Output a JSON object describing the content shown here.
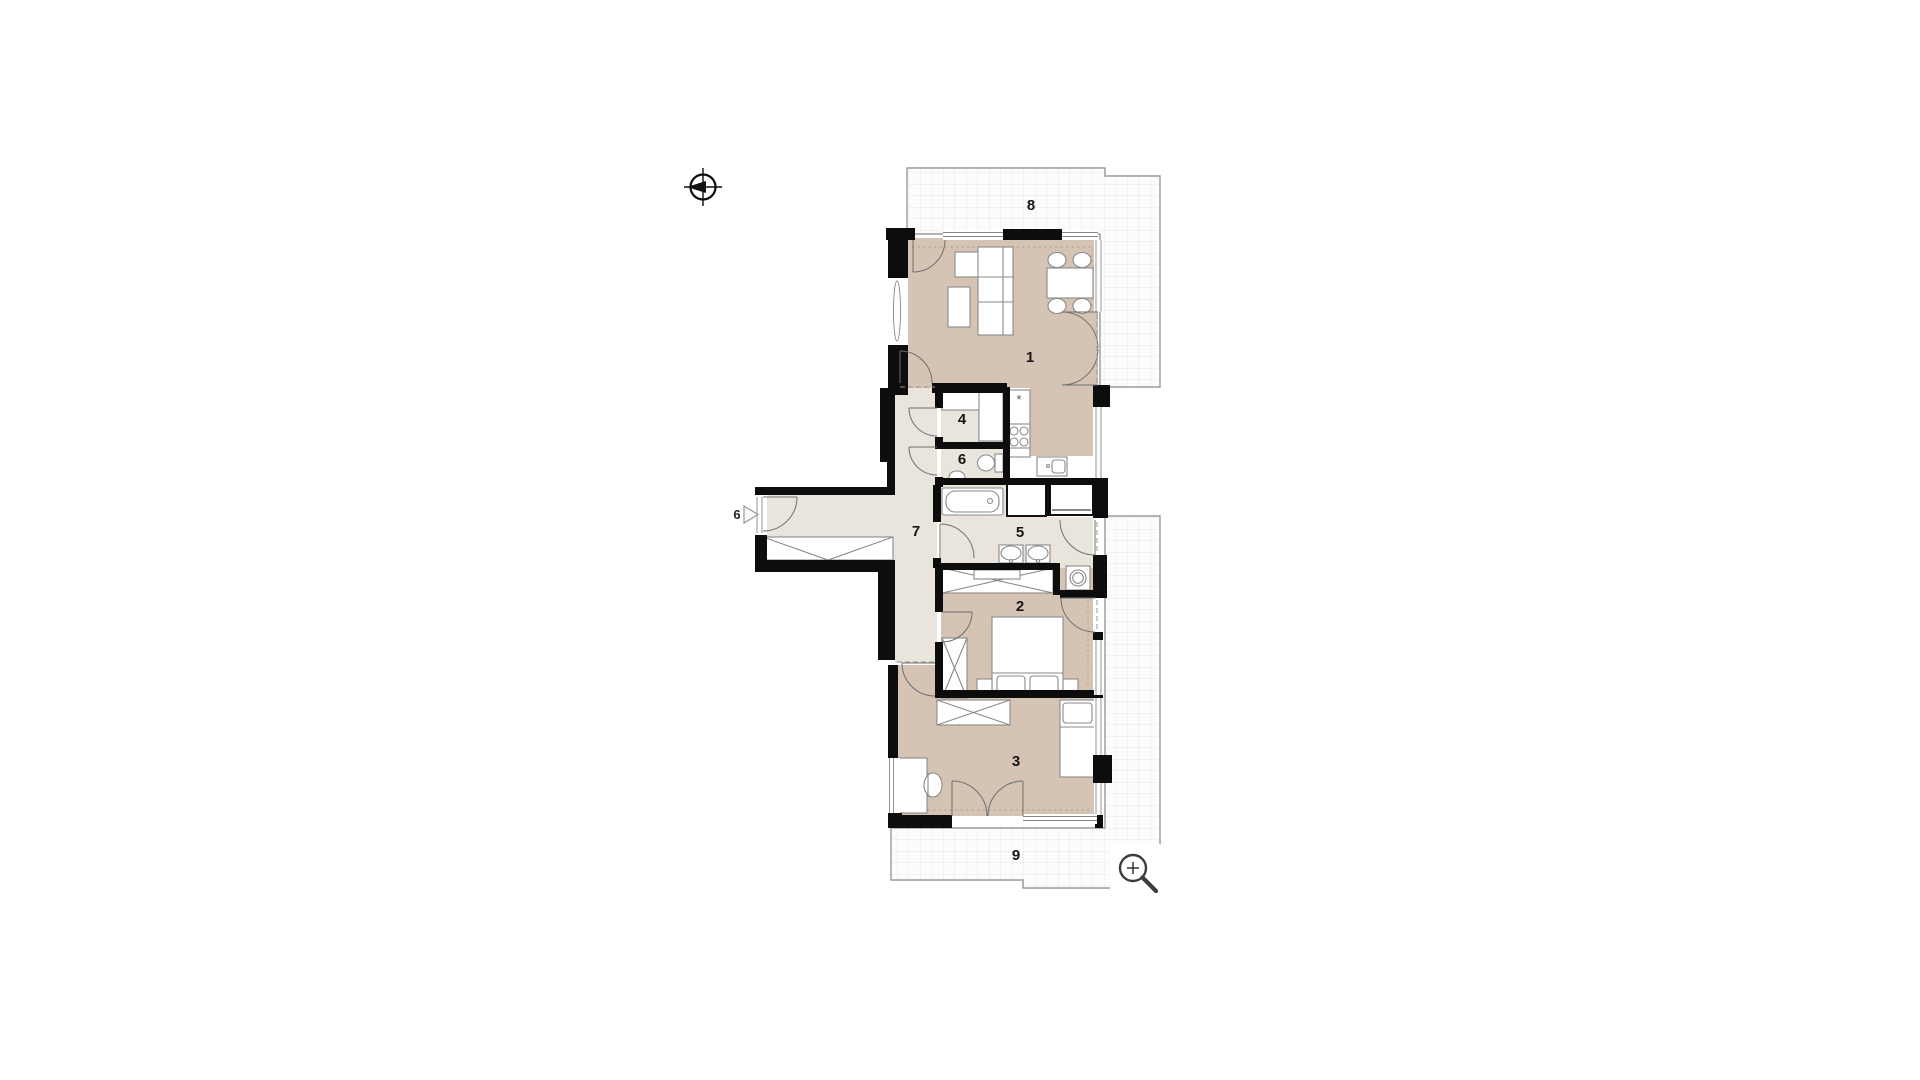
{
  "title": "apartment-floor-plan",
  "colors": {
    "page_background": "#ffffff",
    "room_floor": "#d5c3b4",
    "service_floor": "#e9e4dc",
    "wall": "#0d0d0d",
    "terrace_fill": "#fcfcfb",
    "terrace_grid": "#e5e3e0",
    "terrace_border": "#9b9b9b",
    "furniture_stroke": "#8a8a8a",
    "door_stroke": "#6f6f6f",
    "icon_stroke": "#3d3d3d"
  },
  "rooms": [
    {
      "name": "living-room",
      "label": "1"
    },
    {
      "name": "bedroom",
      "label": "2"
    },
    {
      "name": "bedroom-2",
      "label": "3"
    },
    {
      "name": "storage",
      "label": "4"
    },
    {
      "name": "bathroom",
      "label": "5"
    },
    {
      "name": "wc",
      "label": "6"
    },
    {
      "name": "hallway",
      "label": "7"
    },
    {
      "name": "terrace-north",
      "label": "8"
    },
    {
      "name": "terrace-south",
      "label": "9"
    }
  ],
  "entrance": {
    "unit_label": "6"
  },
  "kitchen": {
    "stove_symbol": "*"
  },
  "icons": {
    "north_arrow": "north-arrow",
    "zoom_button": "zoom-in-magnifier"
  }
}
